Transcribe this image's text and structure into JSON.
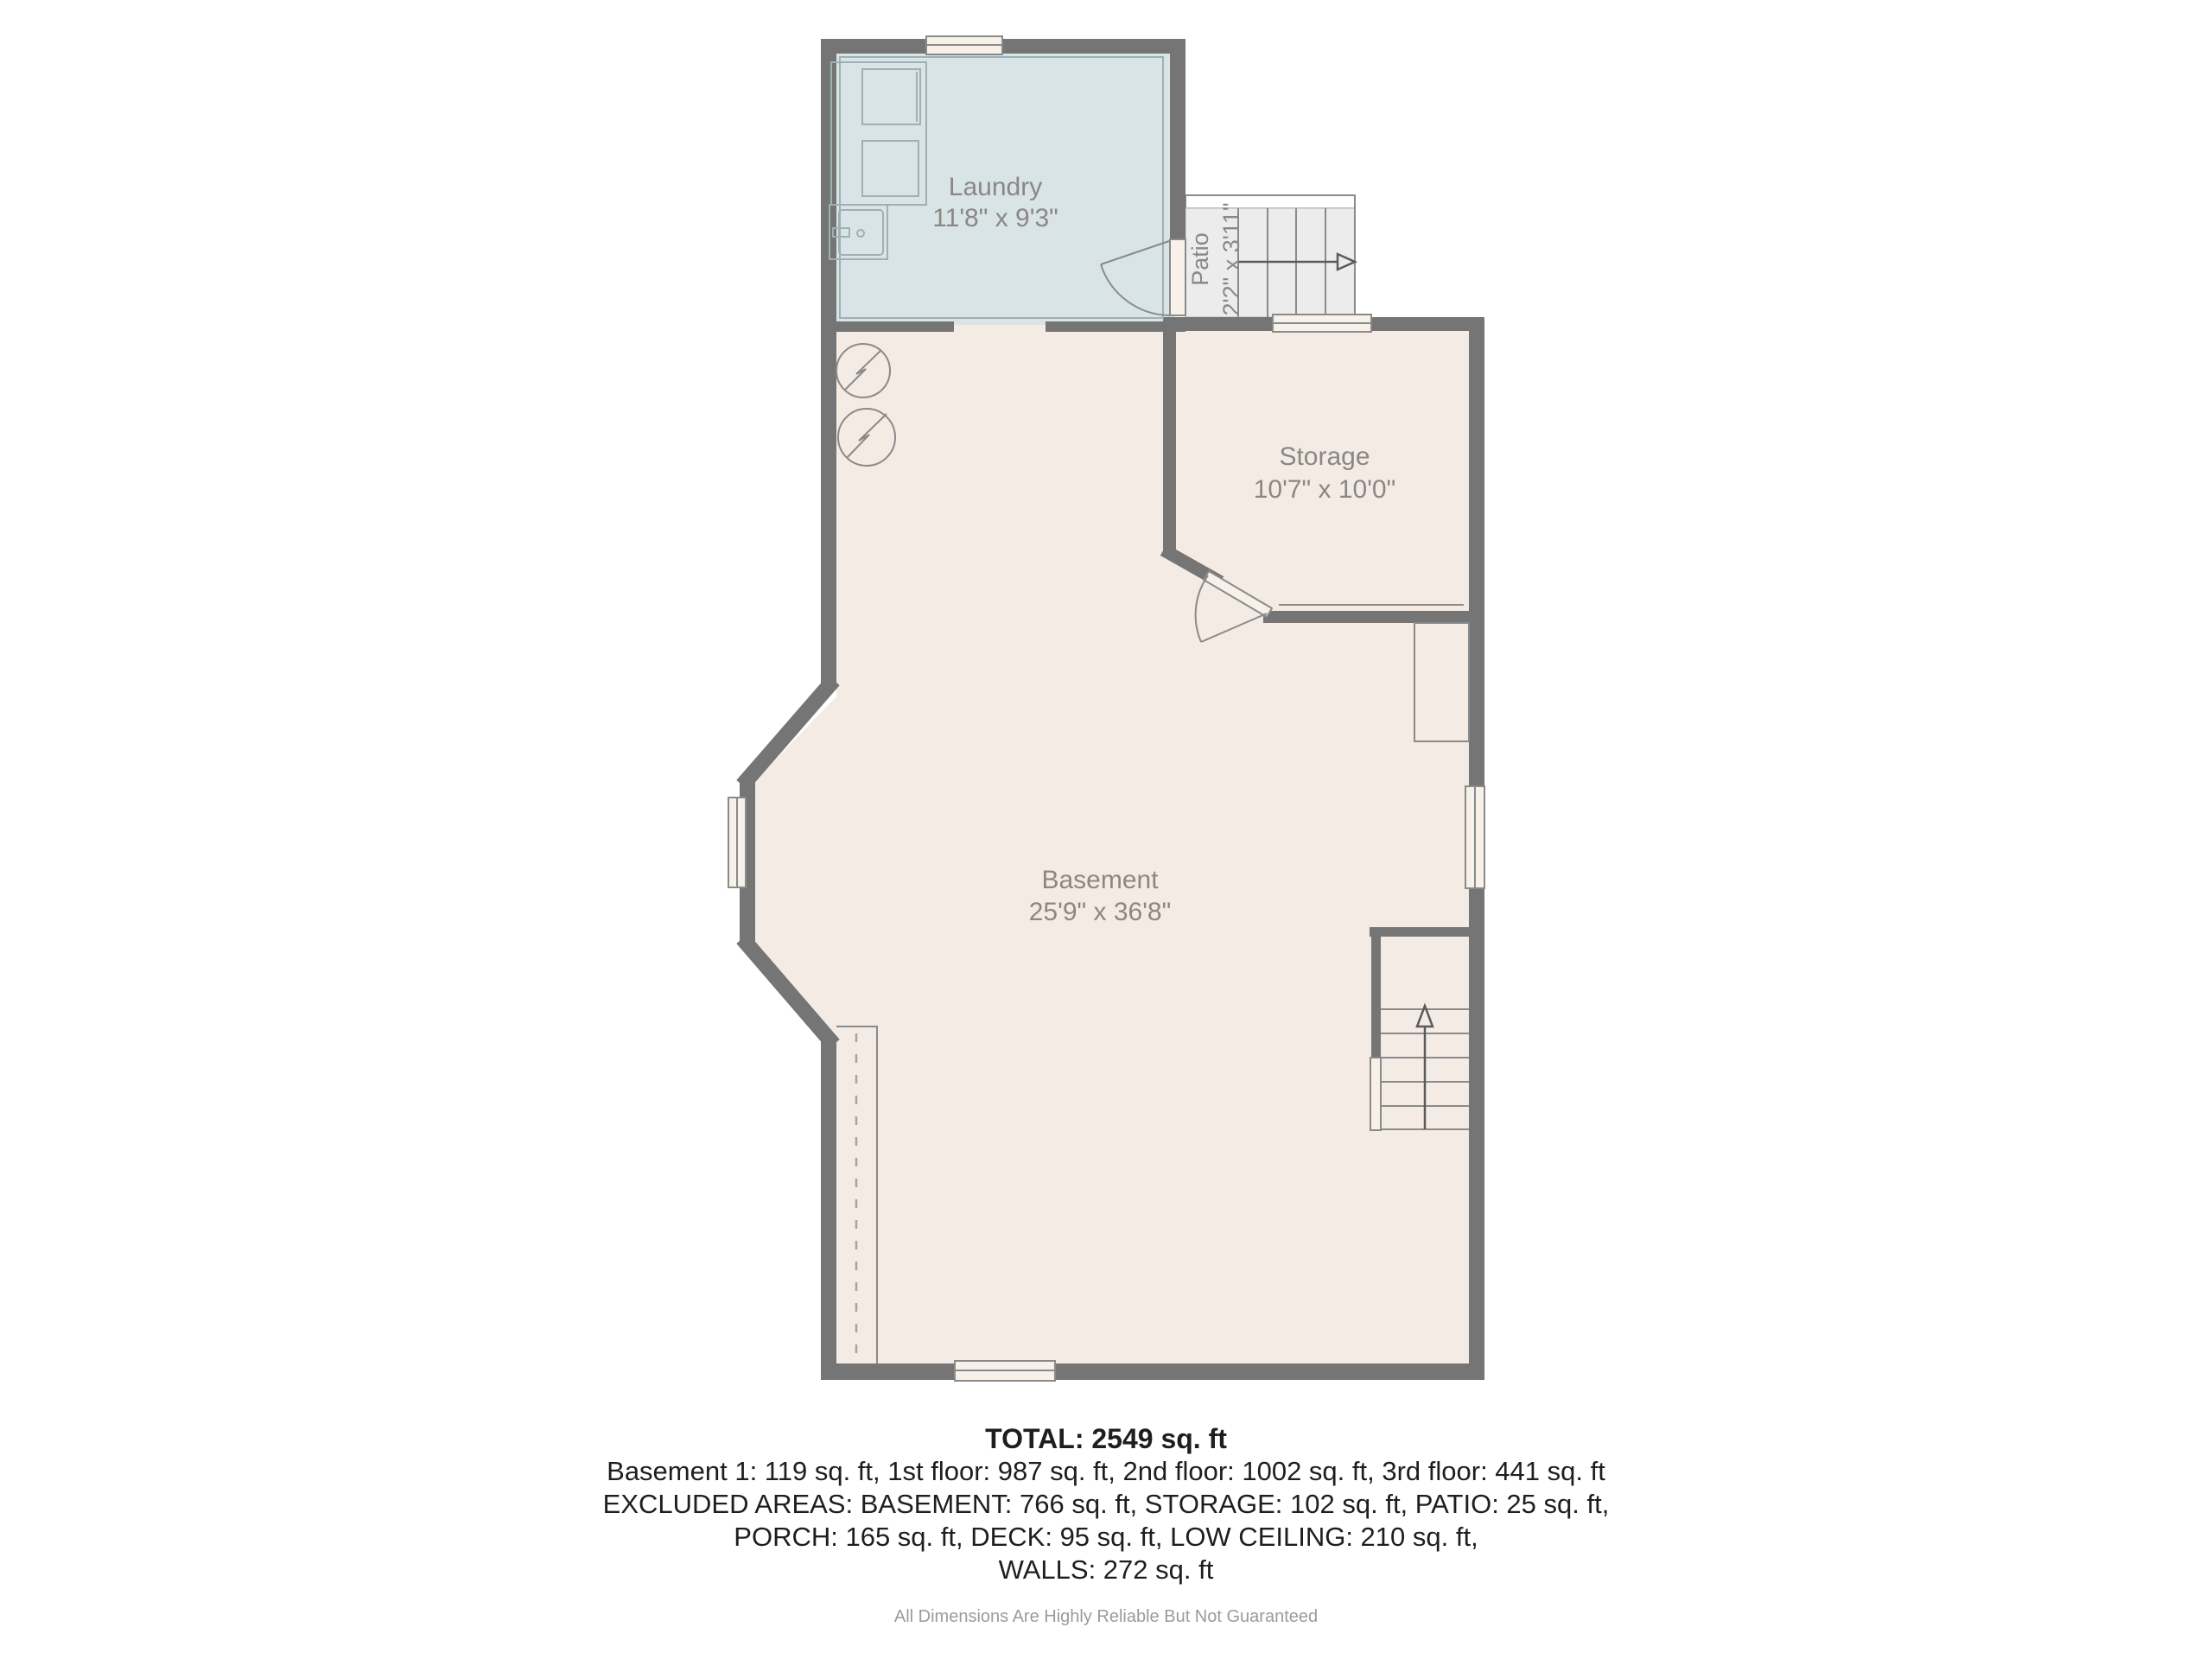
{
  "colors": {
    "wall": "#757575",
    "floor": "#f4ebe5",
    "laundry": "#d9e4e6",
    "patio": "#ececec",
    "window": "#f8f1ea",
    "line": "#8a8a8a",
    "label": "#8b8784",
    "ink": "#1e1e1e",
    "muted": "#9b9b9b"
  },
  "rooms": {
    "laundry": {
      "name": "Laundry",
      "dims": "11'8\" x 9'3\""
    },
    "patio": {
      "name": "Patio",
      "dims": "2'2\" x 3'11\""
    },
    "storage": {
      "name": "Storage",
      "dims": "10'7\" x 10'0\""
    },
    "basement": {
      "name": "Basement",
      "dims": "25'9\" x 36'8\""
    }
  },
  "summary": {
    "total": "TOTAL: 2549 sq. ft",
    "floors": "Basement 1: 119 sq. ft, 1st floor: 987 sq. ft, 2nd floor: 1002 sq. ft, 3rd floor: 441 sq. ft",
    "excluded1": "EXCLUDED AREAS: BASEMENT: 766 sq. ft, STORAGE: 102 sq. ft, PATIO: 25 sq. ft,",
    "excluded2": "PORCH: 165 sq. ft, DECK: 95 sq. ft, LOW CEILING: 210 sq. ft,",
    "excluded3": "WALLS: 272 sq. ft",
    "disclaimer": "All Dimensions Are Highly Reliable But Not Guaranteed"
  }
}
